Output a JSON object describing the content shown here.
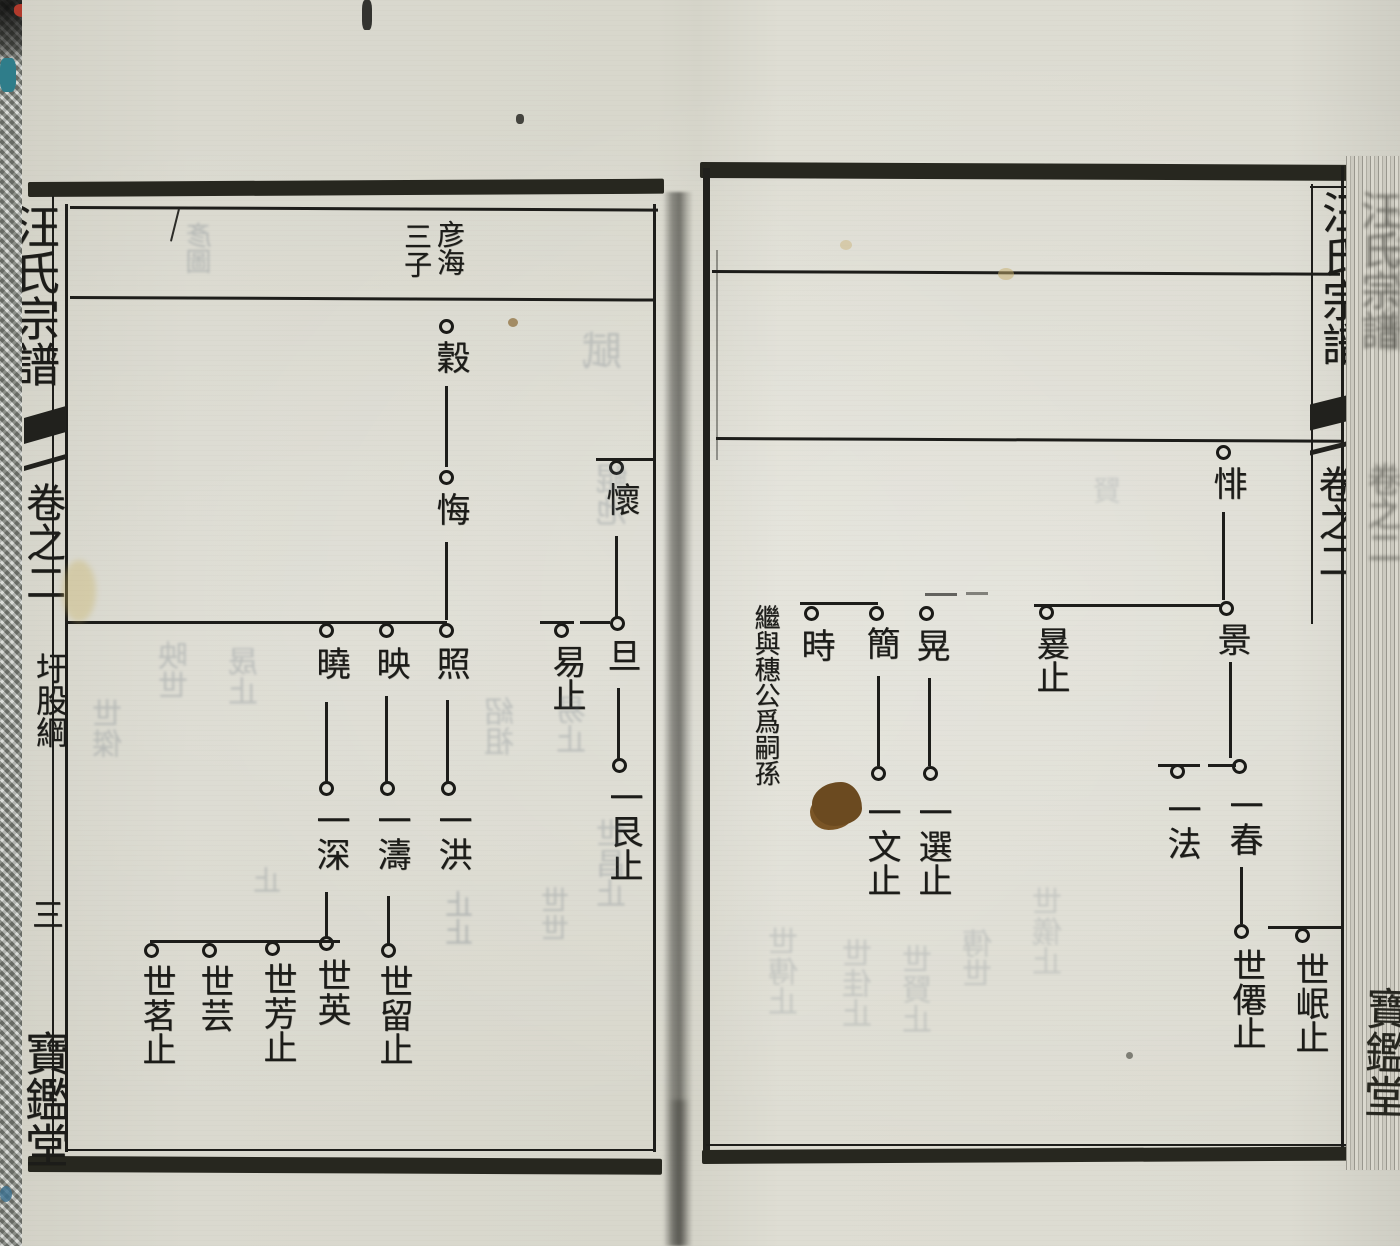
{
  "colors": {
    "ink": "#1c1c19",
    "paper": "#d8d7cd",
    "fabric": "#9aa098",
    "stain_brown": "#6b4a20",
    "red_mark": "#b23a2c",
    "teal_mark": "#2f7d8a"
  },
  "left_page": {
    "margin": {
      "book_title": "汪氏宗譜",
      "volume": "卷之二",
      "section": "圩股綱",
      "page_number": "三",
      "hall_name": "寶鑑堂"
    },
    "header": {
      "right_label": "彦海",
      "left_label": "三子"
    },
    "persons": {
      "gu": {
        "name": "穀"
      },
      "hui": {
        "name": "悔"
      },
      "zhao": {
        "name": "照"
      },
      "ying": {
        "name": "映"
      },
      "xiao": {
        "name": "曉"
      },
      "yi_hong": {
        "name": "一洪"
      },
      "yi_tao": {
        "name": "一濤"
      },
      "yi_shen": {
        "name": "一深"
      },
      "shi_liu": {
        "name": "世留止"
      },
      "shi_ying": {
        "name": "世英"
      },
      "shi_fang": {
        "name": "世芳止"
      },
      "shi_yun": {
        "name": "世芸"
      },
      "shi_ming": {
        "name": "世茗止"
      },
      "huai": {
        "name": "懷"
      },
      "dan": {
        "name": "旦"
      },
      "yi": {
        "name": "易止"
      },
      "yi_gen": {
        "name": "一艮止"
      }
    }
  },
  "right_page": {
    "margin": {
      "book_title": "汪氏宗譜",
      "volume": "卷之二"
    },
    "fore_edge": {
      "ghost_title": "汪氏宗譜",
      "ghost_volume": "卷之二",
      "hall_name": "寶鑑堂"
    },
    "annotation": "繼與穗公爲嗣孫",
    "persons": {
      "fei": {
        "name": "悱"
      },
      "jing": {
        "name": "景"
      },
      "huan": {
        "name": "㬊止"
      },
      "yi_chun": {
        "name": "一春"
      },
      "yi_fa": {
        "name": "一法"
      },
      "shi_xian": {
        "name": "世僊止"
      },
      "shi_min": {
        "name": "世岷止"
      },
      "huang": {
        "name": "晃"
      },
      "yi_xuan": {
        "name": "一選止"
      },
      "jian": {
        "name": "簡"
      },
      "yi_wen": {
        "name": "一文止"
      },
      "shi": {
        "name": "時"
      }
    }
  },
  "decor": {
    "ghosts": [
      {
        "text": "賦"
      },
      {
        "text": "鯤池"
      },
      {
        "text": "彥圖"
      },
      {
        "text": "世傑"
      },
      {
        "text": "映世"
      },
      {
        "text": "晟止"
      },
      {
        "text": "止"
      },
      {
        "text": "紹祖"
      },
      {
        "text": "易止"
      },
      {
        "text": "世昌止"
      },
      {
        "text": "止止"
      },
      {
        "text": "世世"
      },
      {
        "text": "世傳止"
      },
      {
        "text": "世佳止"
      },
      {
        "text": "世賢止"
      },
      {
        "text": "傳世"
      },
      {
        "text": "世儀止"
      },
      {
        "text": "賢"
      }
    ]
  }
}
